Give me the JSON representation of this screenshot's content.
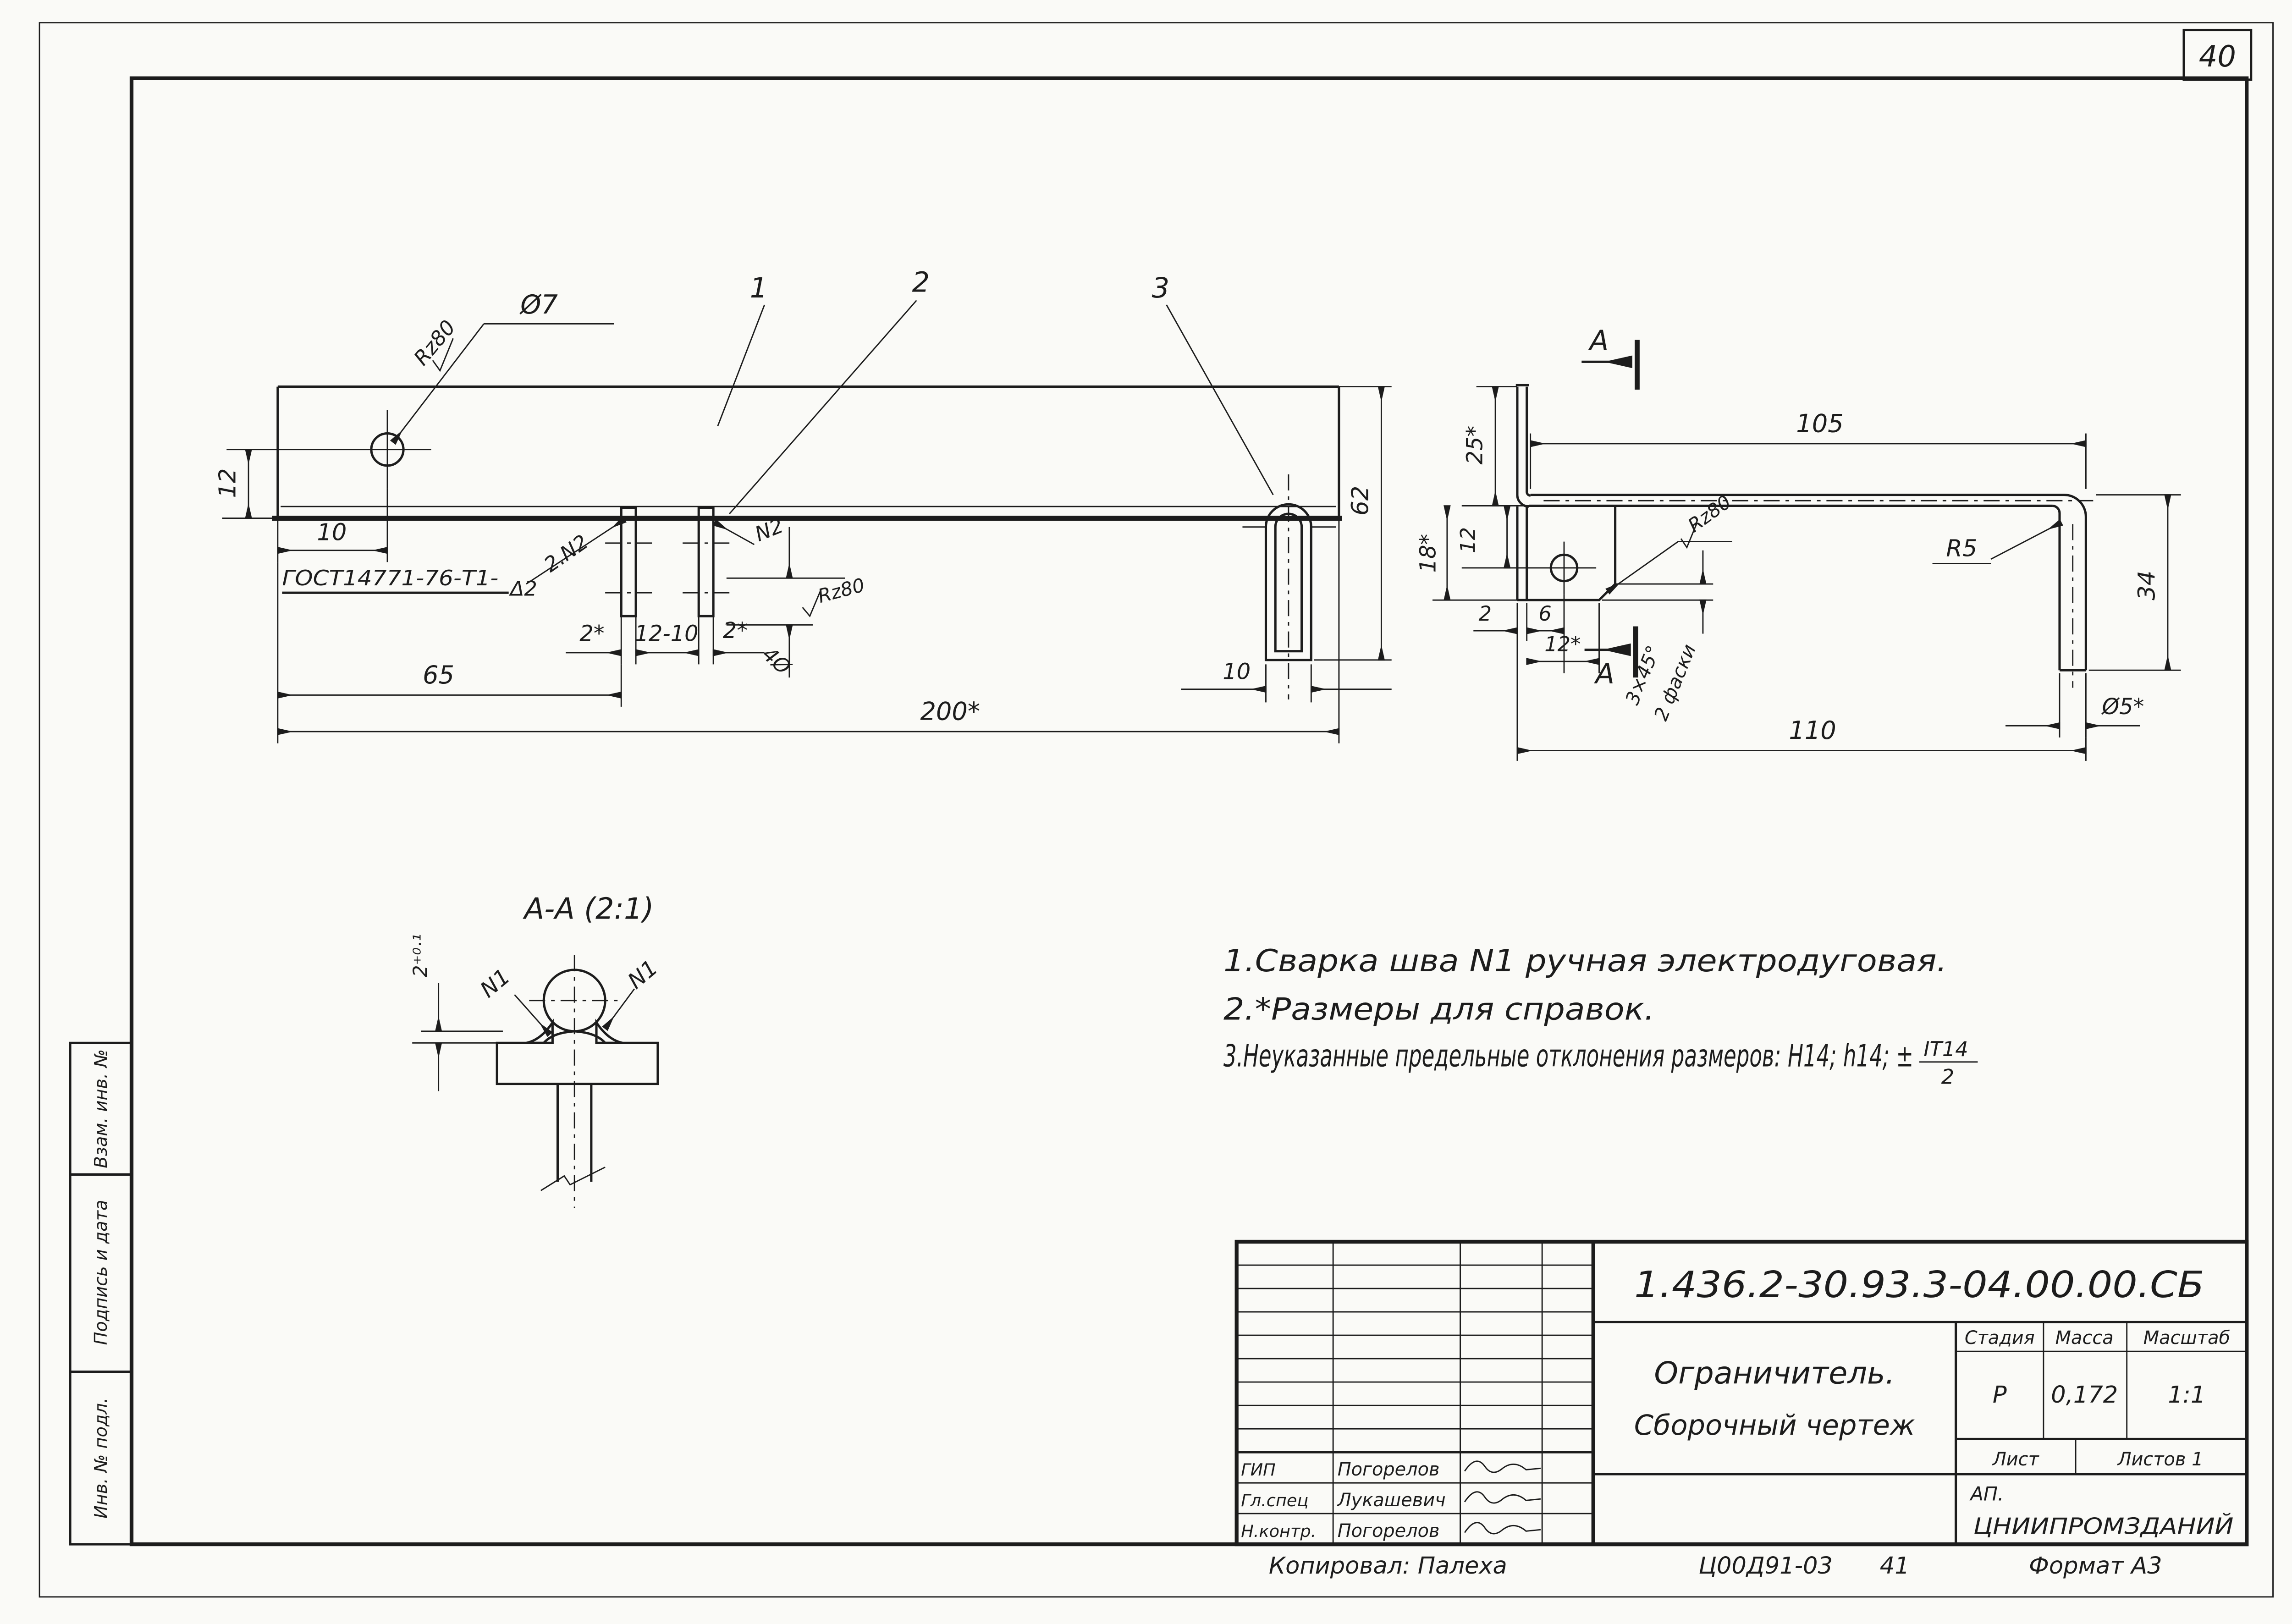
{
  "page": {
    "sheet_number": "40",
    "copied_by": "Копировал: Палеха",
    "doc_code": "Ц00Д91-03",
    "doc_code_sheet": "41",
    "format_note": "Формат А3"
  },
  "side_strip": {
    "cells": [
      "Взам. инв. №",
      "Подпись и дата",
      "Инв. № подл."
    ]
  },
  "notes": {
    "line1": "1.Сварка шва N1 ручная электродуговая.",
    "line2": "2.*Размеры для справок.",
    "line3": "3.Неуказанные предельные отклонения размеров: Н14; h14; ±",
    "line3_frac_num": "IT14",
    "line3_frac_den": "2"
  },
  "plan_view": {
    "callouts": {
      "p1": "1",
      "p2": "2",
      "p3": "3"
    },
    "hole": {
      "rough": "Rz80",
      "dia": "Ø7"
    },
    "weld": {
      "gost": "ГОСТ14771-76-Т1-",
      "symbol": "Δ2",
      "leader": "2.N2",
      "n2": "N2"
    },
    "dims": {
      "v12": "12",
      "h10": "10",
      "pin_l": "2*",
      "pin_mid": "12-10",
      "pin_r": "2*",
      "pin_dia": "4Ø",
      "pin_rough": "Rz80",
      "d65": "65",
      "d200": "200*",
      "d62": "62",
      "hook10": "10"
    }
  },
  "side_view": {
    "dims": {
      "d25": "25*",
      "d18": "18*",
      "d12": "12",
      "d2": "2",
      "d6": "6",
      "d12s": "12*",
      "rough": "Rz80",
      "chamfer": "3×45°",
      "chamfer_qty": "2 фаски",
      "d105": "105",
      "r5": "R5",
      "d34": "34",
      "dia5": "Ø5*",
      "d110": "110"
    },
    "marks": {
      "top": "А",
      "bottom": "А"
    }
  },
  "section_view": {
    "title": "А-А (2:1)",
    "n1_left": "N1",
    "n1_right": "N1",
    "depth": "2⁺⁰·¹"
  },
  "title_block": {
    "doc_number": "1.436.2-30.93.3-04.00.00.СБ",
    "title_line1": "Ограничитель.",
    "title_line2": "Сборочный чертеж",
    "stage_label": "Стадия",
    "mass_label": "Масса",
    "scale_label": "Масштаб",
    "stage": "Р",
    "mass": "0,172",
    "scale": "1:1",
    "sheet_label": "Лист",
    "sheets_label": "Листов 1",
    "org_prefix": "АП.",
    "org": "ЦНИИПРОМЗДАНИЙ",
    "signatures": [
      {
        "role": "ГИП",
        "name": "Погорелов"
      },
      {
        "role": "Гл.спец",
        "name": "Лукашевич"
      },
      {
        "role": "Н.контр.",
        "name": "Погорелов"
      }
    ]
  }
}
